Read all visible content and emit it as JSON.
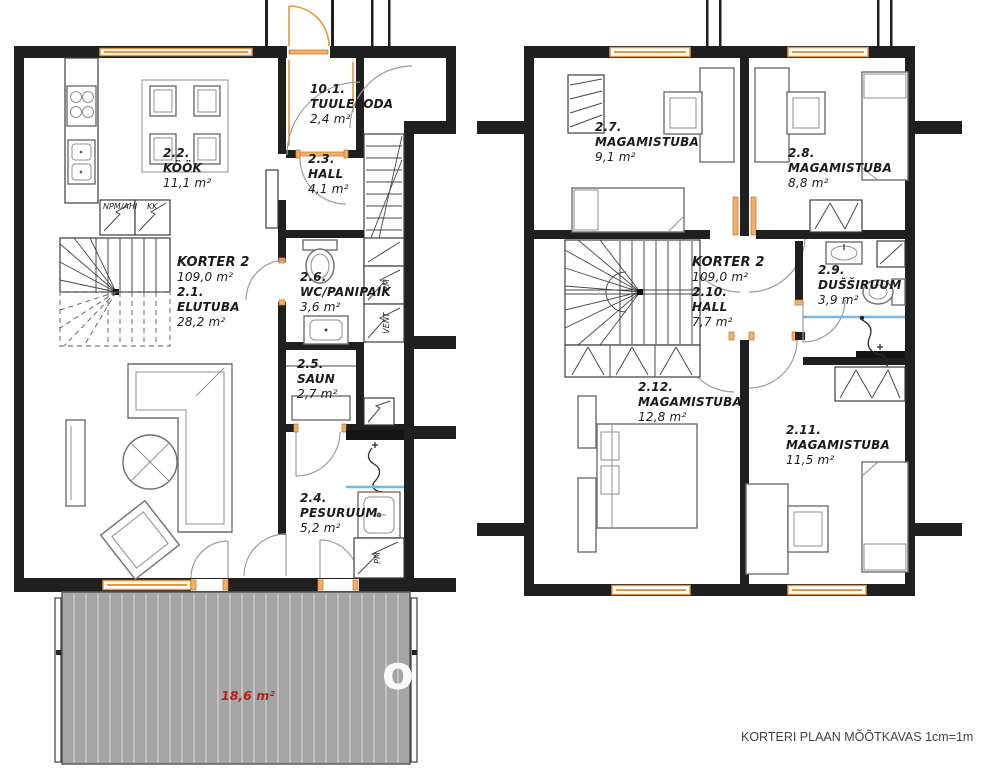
{
  "colors": {
    "wall": "#1f1f1f",
    "window_accent": "#e8953f",
    "terrace_fill": "#a5a5a5",
    "terrace_text": "#b92121",
    "shower_line": "#79b5e6"
  },
  "caption": "KORTERI PLAAN MÕÕTKAVAS 1cm=1m",
  "watermark": "o",
  "floor1": {
    "apartment_name": "KORTER 2",
    "apartment_area": "109,0 m²",
    "rooms": {
      "tuulekoda": {
        "number": "10.1.",
        "name": "TUULEKODA",
        "area": "2,4 m²"
      },
      "kook": {
        "number": "2.2.",
        "name": "KÖÖK",
        "area": "11,1 m²"
      },
      "hall": {
        "number": "2.3.",
        "name": "HALL",
        "area": "4,1 m²"
      },
      "elutuba": {
        "number": "2.1.",
        "name": "ELUTUBA",
        "area": "28,2 m²"
      },
      "wc_panipaik": {
        "number": "2.6.",
        "name": "WC/PANIPAIK",
        "area": "3,6 m²"
      },
      "saun": {
        "number": "2.5.",
        "name": "SAUN",
        "area": "2,7 m²"
      },
      "pesuruum": {
        "number": "2.4.",
        "name": "PESURUUM",
        "area": "5,2 m²"
      }
    },
    "terrace_area": "18,6 m²",
    "equipment": {
      "npm_ahi": "NPM/AHI",
      "kk": "KK",
      "pm": "PM",
      "vent": "VENT",
      "pm_washer": "PM"
    }
  },
  "floor2": {
    "apartment_name": "KORTER 2",
    "apartment_area": "109,0 m²",
    "rooms": {
      "magamistuba_27": {
        "number": "2.7.",
        "name": "MAGAMISTUBA",
        "area": "9,1 m²"
      },
      "magamistuba_28": {
        "number": "2.8.",
        "name": "MAGAMISTUBA",
        "area": "8,8 m²"
      },
      "hall": {
        "number": "2.10.",
        "name": "HALL",
        "area": "7,7 m²"
      },
      "dussiruum": {
        "number": "2.9.",
        "name": "DUŠŠIRUUM",
        "area": "3,9 m²"
      },
      "magamistuba_212": {
        "number": "2.12.",
        "name": "MAGAMISTUBA",
        "area": "12,8 m²"
      },
      "magamistuba_211": {
        "number": "2.11.",
        "name": "MAGAMISTUBA",
        "area": "11,5 m²"
      }
    }
  }
}
